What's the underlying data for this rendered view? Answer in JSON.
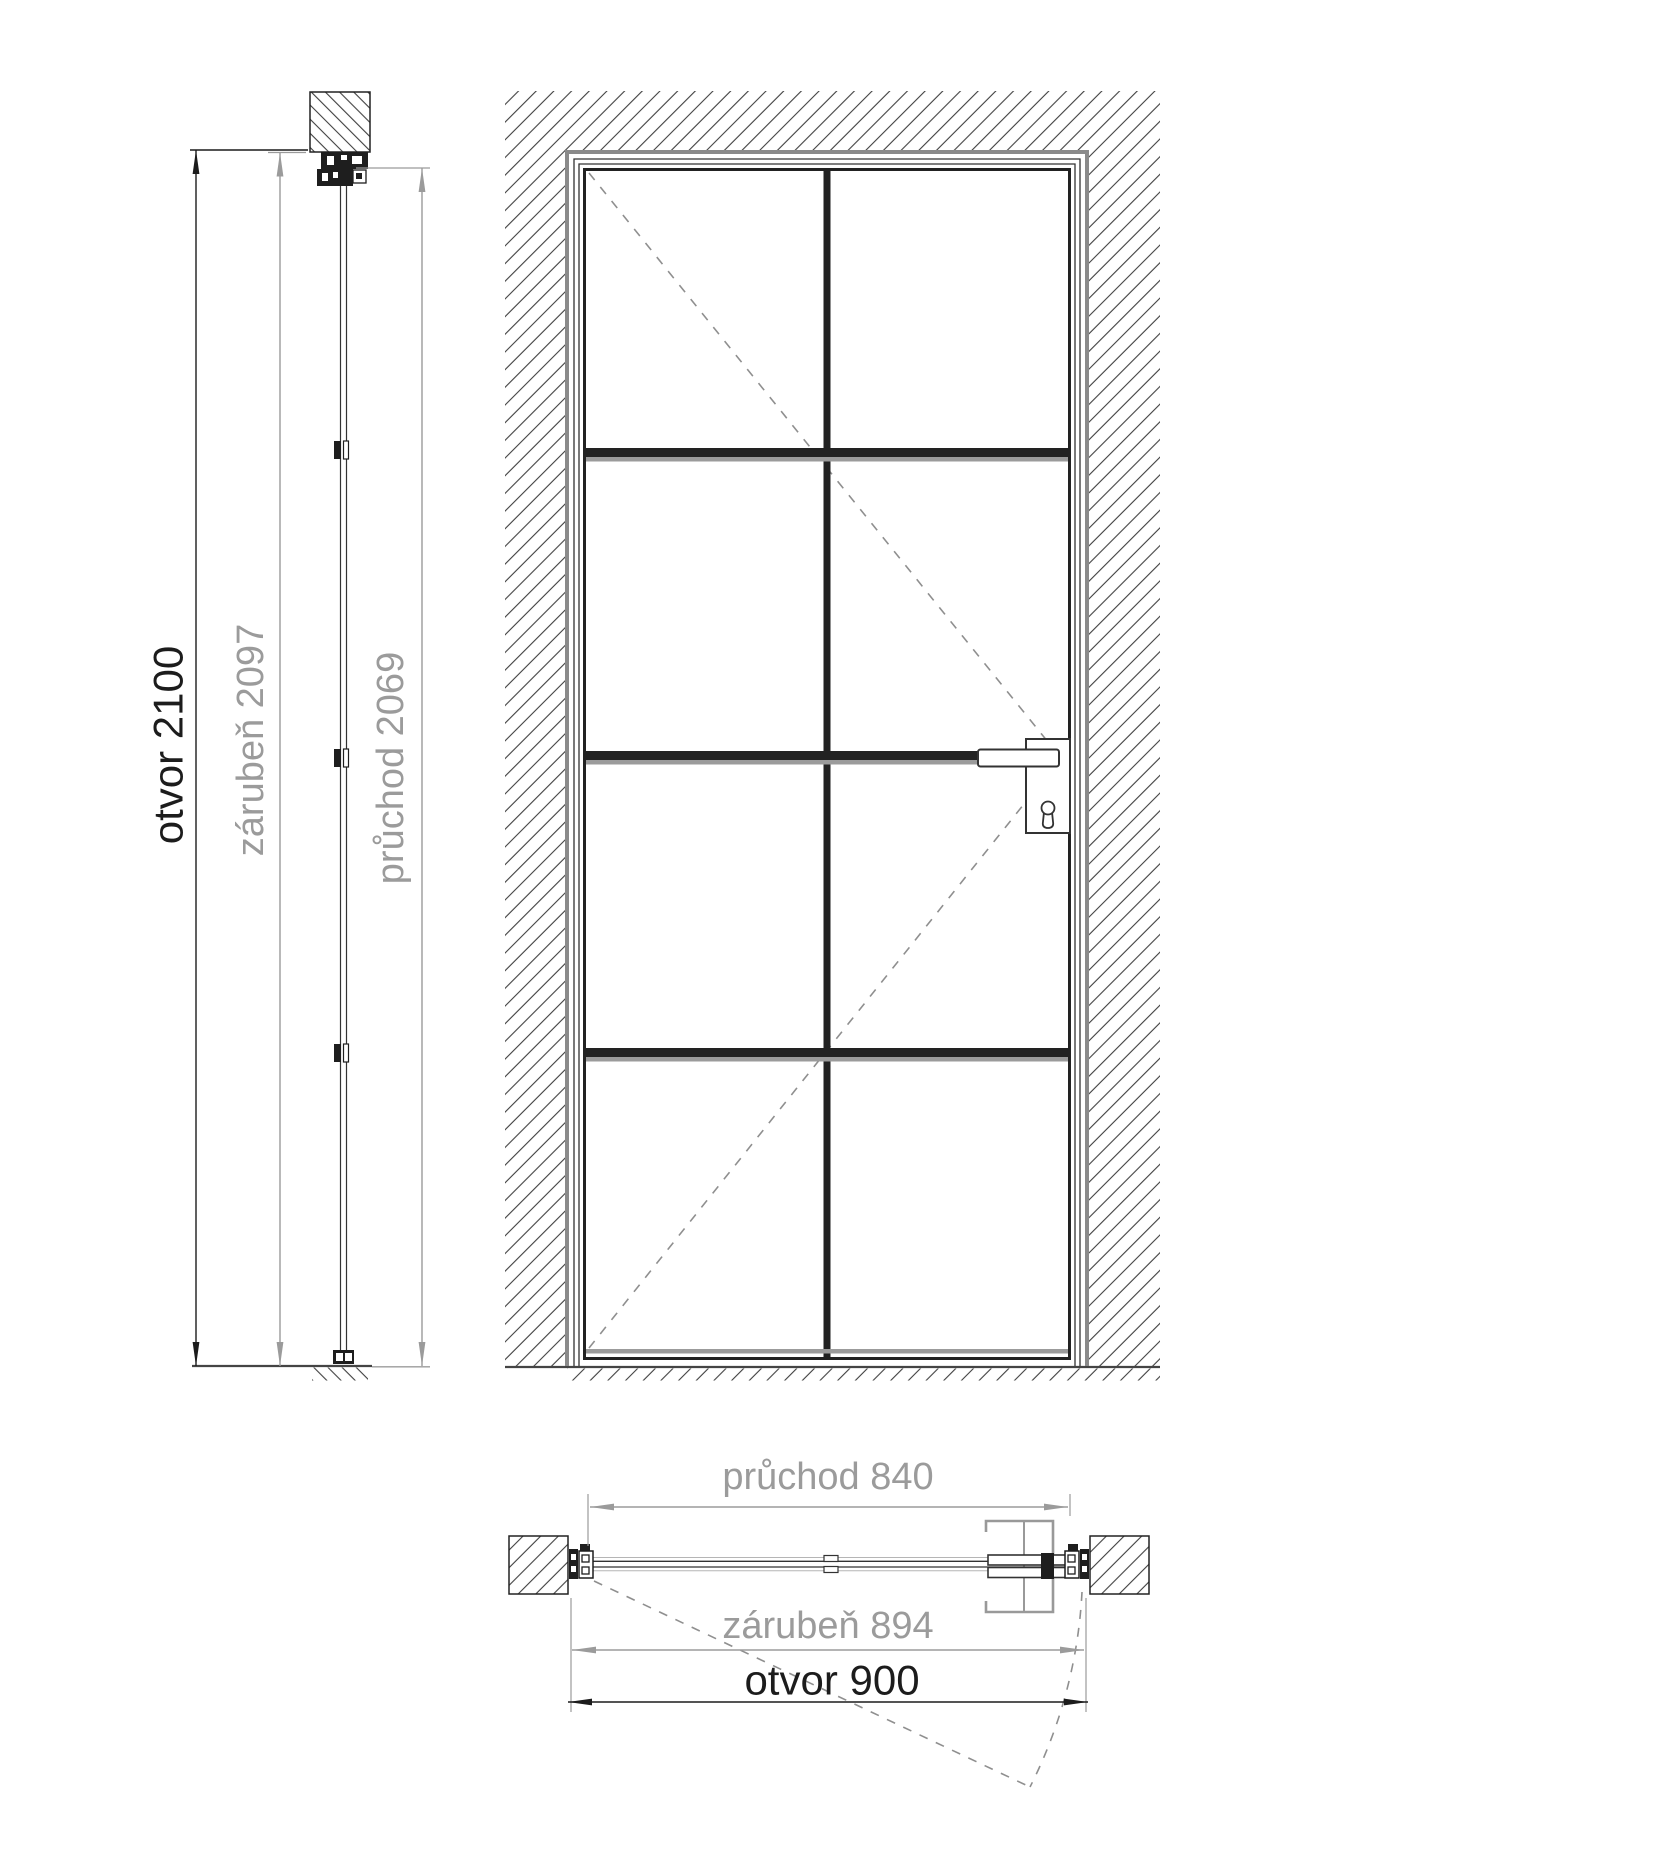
{
  "drawing": {
    "title": "door-dimension-drawing",
    "section": {
      "otvor": "otvor 2100",
      "zaruben": "zárubeň 2097",
      "pruchod": "průchod 2069"
    },
    "plan": {
      "pruchod": "průchod 840",
      "zaruben": "zárubeň 894",
      "otvor": "otvor 900"
    },
    "values": {
      "opening_height_mm": 2100,
      "frame_height_mm": 2097,
      "passage_height_mm": 2069,
      "passage_width_mm": 840,
      "frame_width_mm": 894,
      "opening_width_mm": 900
    },
    "colors": {
      "line": "#222222",
      "dim_gray": "#9b9b9b",
      "shadow_gray": "#8a8a8a",
      "background": "#ffffff"
    }
  }
}
